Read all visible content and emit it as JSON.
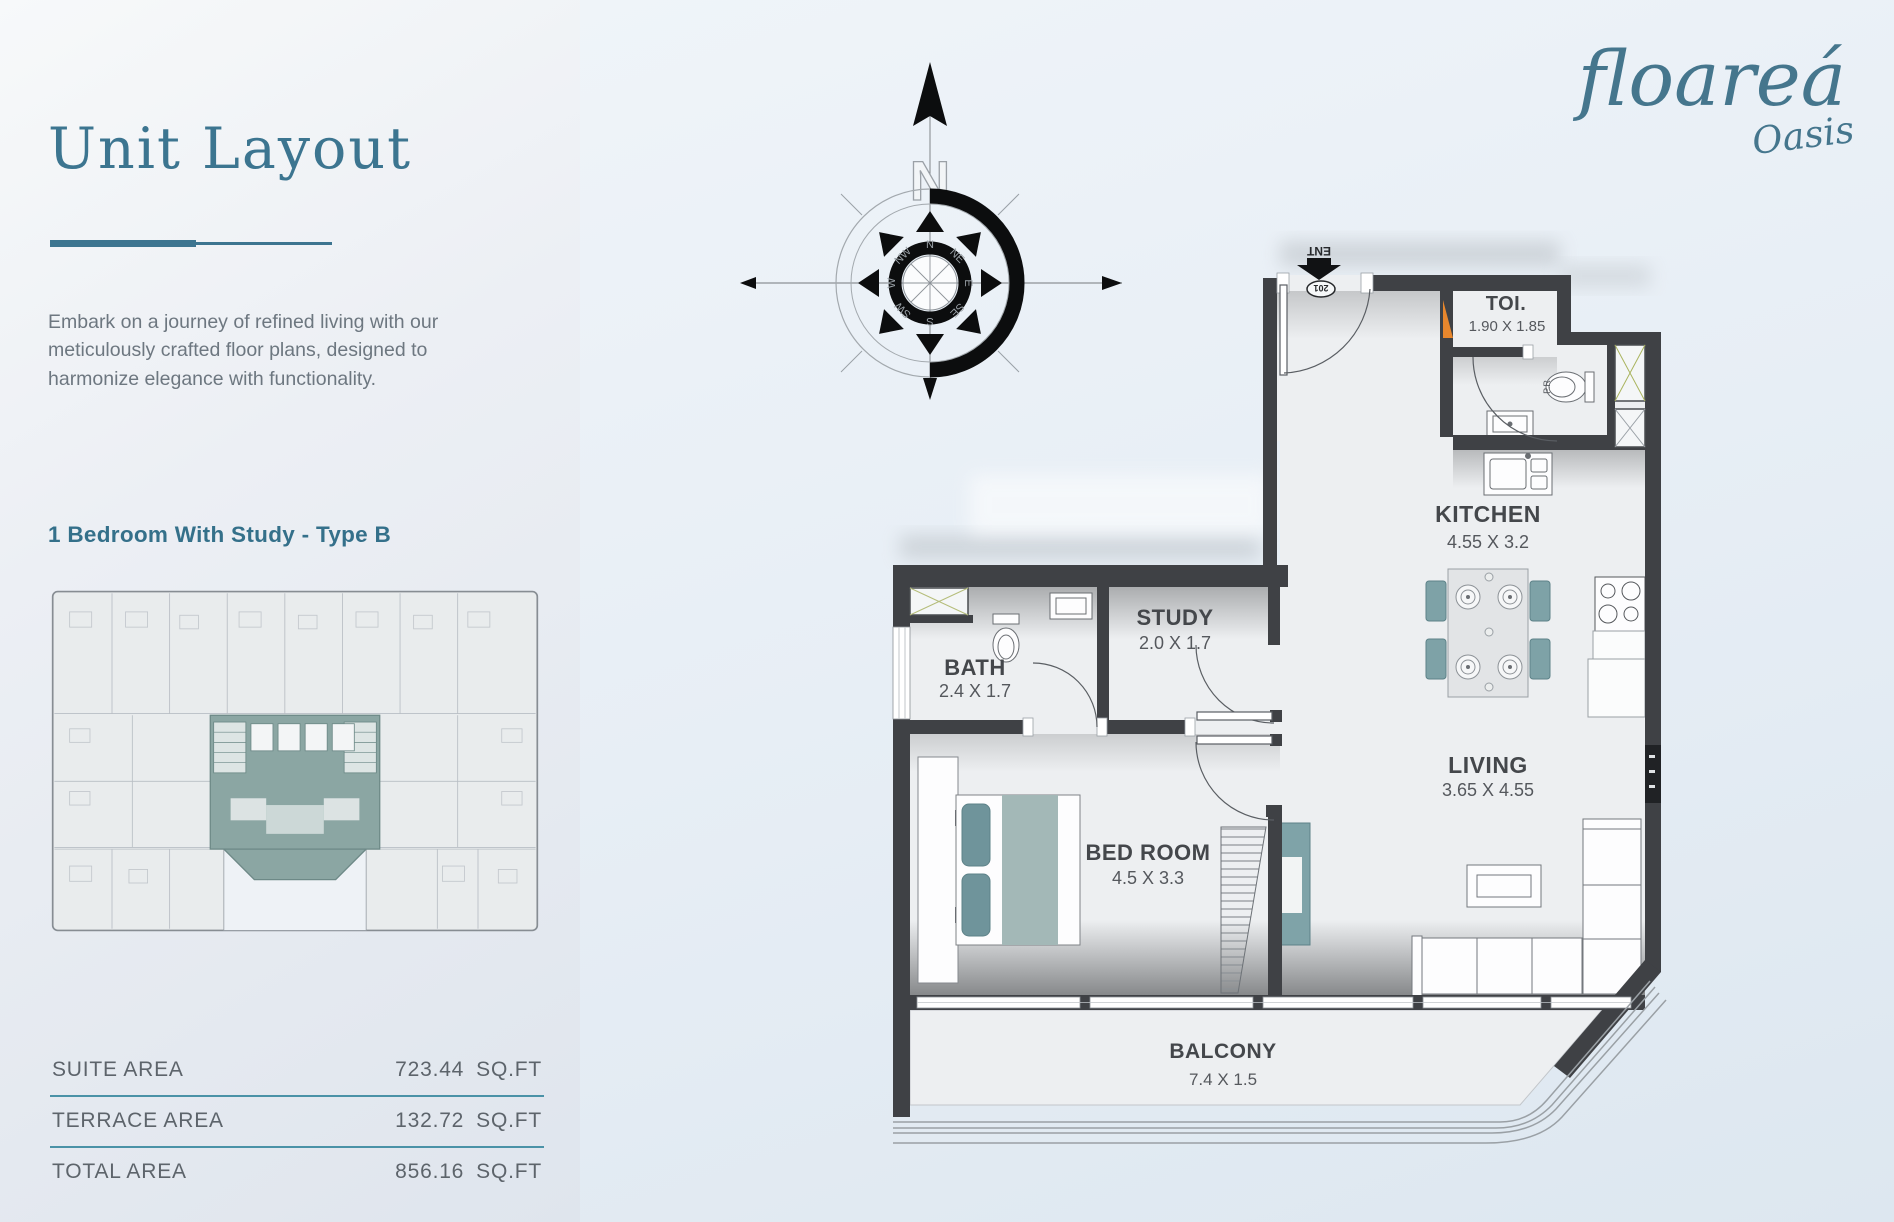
{
  "sidebar": {
    "title": "Unit Layout",
    "description": "Embark on a journey of refined living with our meticulously crafted floor plans, designed to harmonize elegance with functionality.",
    "unit_type": "1 Bedroom With Study - Type B",
    "areas": [
      {
        "label": "SUITE AREA",
        "value": "723.44",
        "unit": "SQ.FT"
      },
      {
        "label": "TERRACE AREA",
        "value": "132.72",
        "unit": "SQ.FT"
      },
      {
        "label": "TOTAL AREA",
        "value": "856.16",
        "unit": "SQ.FT"
      }
    ]
  },
  "logo": {
    "primary": "floareá",
    "secondary": "Oasis"
  },
  "compass": {
    "letter": "N",
    "points": [
      "N",
      "NE",
      "E",
      "SE",
      "S",
      "SW",
      "W",
      "NW"
    ]
  },
  "floorplan": {
    "entry_label": "ENT",
    "unit_number": "201",
    "pr_label": "P.R",
    "rooms": {
      "toi": {
        "name": "TOI.",
        "dims": "1.90 X 1.85"
      },
      "kitchen": {
        "name": "KITCHEN",
        "dims": "4.55 X 3.2"
      },
      "study": {
        "name": "STUDY",
        "dims": "2.0 X 1.7"
      },
      "bath": {
        "name": "BATH",
        "dims": "2.4 X 1.7"
      },
      "bedroom": {
        "name": "BED ROOM",
        "dims": "4.5 X 3.3"
      },
      "living": {
        "name": "LIVING",
        "dims": "3.65 X 4.55"
      },
      "balcony": {
        "name": "BALCONY",
        "dims": "7.4 X 1.5"
      }
    },
    "colors": {
      "accent": "#3a768e",
      "wall": "#3f4145",
      "floor": "#edeff1",
      "teal_furniture": "#7fa3a8",
      "orange_door": "#e8872d",
      "table_divider": "#4a92a7"
    }
  }
}
